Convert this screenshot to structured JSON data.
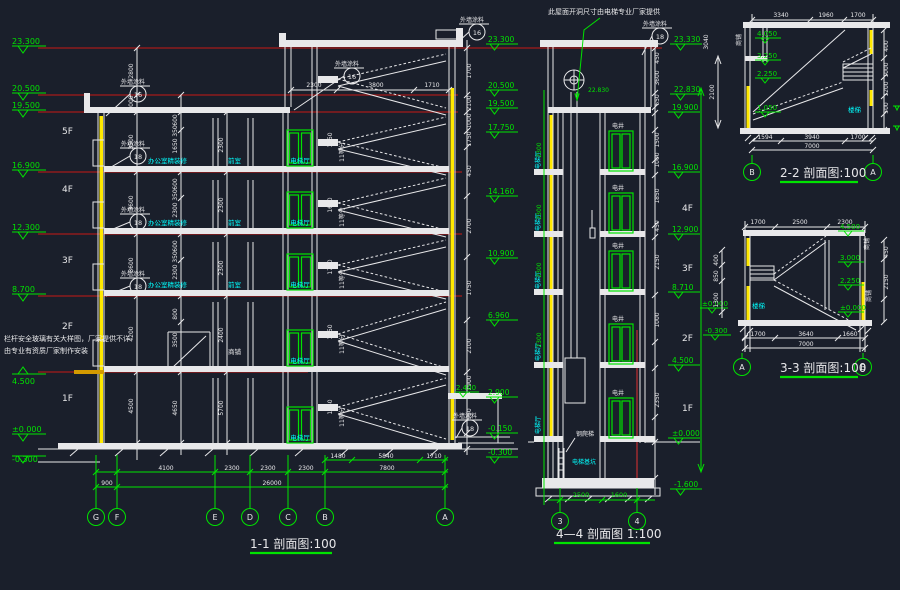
{
  "colors": {
    "background": "#1a1f2b",
    "line": "#e8e8ea",
    "level_line": "#8e1c1c",
    "dimension": "#00e400",
    "room_text": "#00ffff",
    "wall_fill": "#ffe900",
    "canopy": "#d49a00"
  },
  "s1": {
    "title": "1-1 剖面图:100",
    "floors": [
      "5F",
      "4F",
      "3F",
      "2F",
      "1F"
    ],
    "left_levels": [
      "23.300",
      "20.500",
      "19.500",
      "16.900",
      "12.300",
      "8.700",
      "4.500",
      "±0.000",
      "-0.300"
    ],
    "right_levels": [
      "23.300",
      "20.500",
      "19.500",
      "17.750",
      "14.160",
      "10.900",
      "6.960",
      "2.900",
      "-0.150",
      "-0.300"
    ],
    "canopy_level": "2.400",
    "left_dims1": [
      "2800",
      "1000",
      "3500",
      "3600",
      "3600",
      "4200",
      "4500"
    ],
    "left_dims2": [
      "600",
      "350",
      "1650",
      "600",
      "350",
      "2300",
      "600",
      "350",
      "2300",
      "800",
      "3500",
      "4650"
    ],
    "left_dims3": [
      "2300",
      "2300",
      "2300",
      "2400",
      "5700"
    ],
    "tower_dims": [
      "2300",
      "3800",
      "1710"
    ],
    "right_dims": [
      "1700",
      "2100",
      "1000",
      "1750",
      "450",
      "2700",
      "1750",
      "2100",
      "1900",
      "950"
    ],
    "stair_dims": [
      "1750",
      "1650",
      "1750",
      "1650",
      "1750"
    ],
    "stair_eq": "11等分",
    "axes": [
      "G",
      "F",
      "E",
      "D",
      "C",
      "B",
      "A"
    ],
    "dims_row1": [
      "4100",
      "2300",
      "2300",
      "2300",
      "7800"
    ],
    "dims_sub": [
      "1480",
      "5840",
      "1710"
    ],
    "dims_row2": [
      "900",
      "26000"
    ],
    "room_hall": "电梯厅",
    "room_office": "办公室精装修",
    "room_front": "前室",
    "room_shop": "商铺",
    "paint_label": "外墙涂料",
    "paint_16": "16",
    "paint_18": "18",
    "note1": "栏杆安全玻璃有关大样图，厂家提供不详",
    "note2": "由专业有资质厂家制作安装"
  },
  "s4": {
    "title": "4—4 剖面图 1:100",
    "note": "此屋面开洞尺寸由电梯专业厂家提供",
    "levels": [
      "23.330",
      "22.830",
      "19.900",
      "16.900",
      "12.900",
      "8.710",
      "4.500",
      "±0.000",
      "-1.600"
    ],
    "machine_level": "22.830",
    "floors": [
      "4F",
      "3F",
      "2F",
      "1F"
    ],
    "shaft": "电井",
    "hall": "电梯厅",
    "ladder": "钢爬梯",
    "pit": "电梯基坑",
    "left_dims": [
      "2300",
      "2300",
      "2300",
      "2300"
    ],
    "right_dims": [
      "450",
      "3600",
      "650",
      "1500",
      "1000",
      "1850",
      "450",
      "2150",
      "1000",
      "2350"
    ],
    "bottom_dims": [
      "2500",
      "1600"
    ],
    "axes": [
      "3",
      "4"
    ]
  },
  "s2": {
    "title": "2-2 剖面图:100",
    "top_dims": [
      "3340",
      "1960",
      "1700"
    ],
    "bottom_dims": [
      "1594",
      "3940",
      "1700"
    ],
    "total": "7000",
    "levels": [
      "4.050",
      "3.250",
      "2.250",
      "1.050"
    ],
    "left_dim": "2100",
    "left_dim2": "3040",
    "right_dims": [
      "400",
      "1000",
      "1200",
      "500"
    ],
    "axes": [
      "B",
      "A"
    ],
    "room": "商铺",
    "stair_label": "楼梯"
  },
  "s3": {
    "title": "3-3 剖面图:100",
    "top_dims": [
      "1700",
      "2500",
      "2300"
    ],
    "bottom_dims": [
      "1700",
      "3640",
      "1660"
    ],
    "total": "7000",
    "levels_right": [
      "4.500",
      "3.000",
      "2.250",
      "±0.000"
    ],
    "levels_left": [
      "±0.000",
      "-0.300"
    ],
    "left_dims": [
      "400",
      "850",
      "1300"
    ],
    "right_dims": [
      "450",
      "2150"
    ],
    "axes": [
      "A",
      "B"
    ],
    "rooms": [
      "商铺",
      "商铺"
    ],
    "stair_label": "楼梯"
  }
}
